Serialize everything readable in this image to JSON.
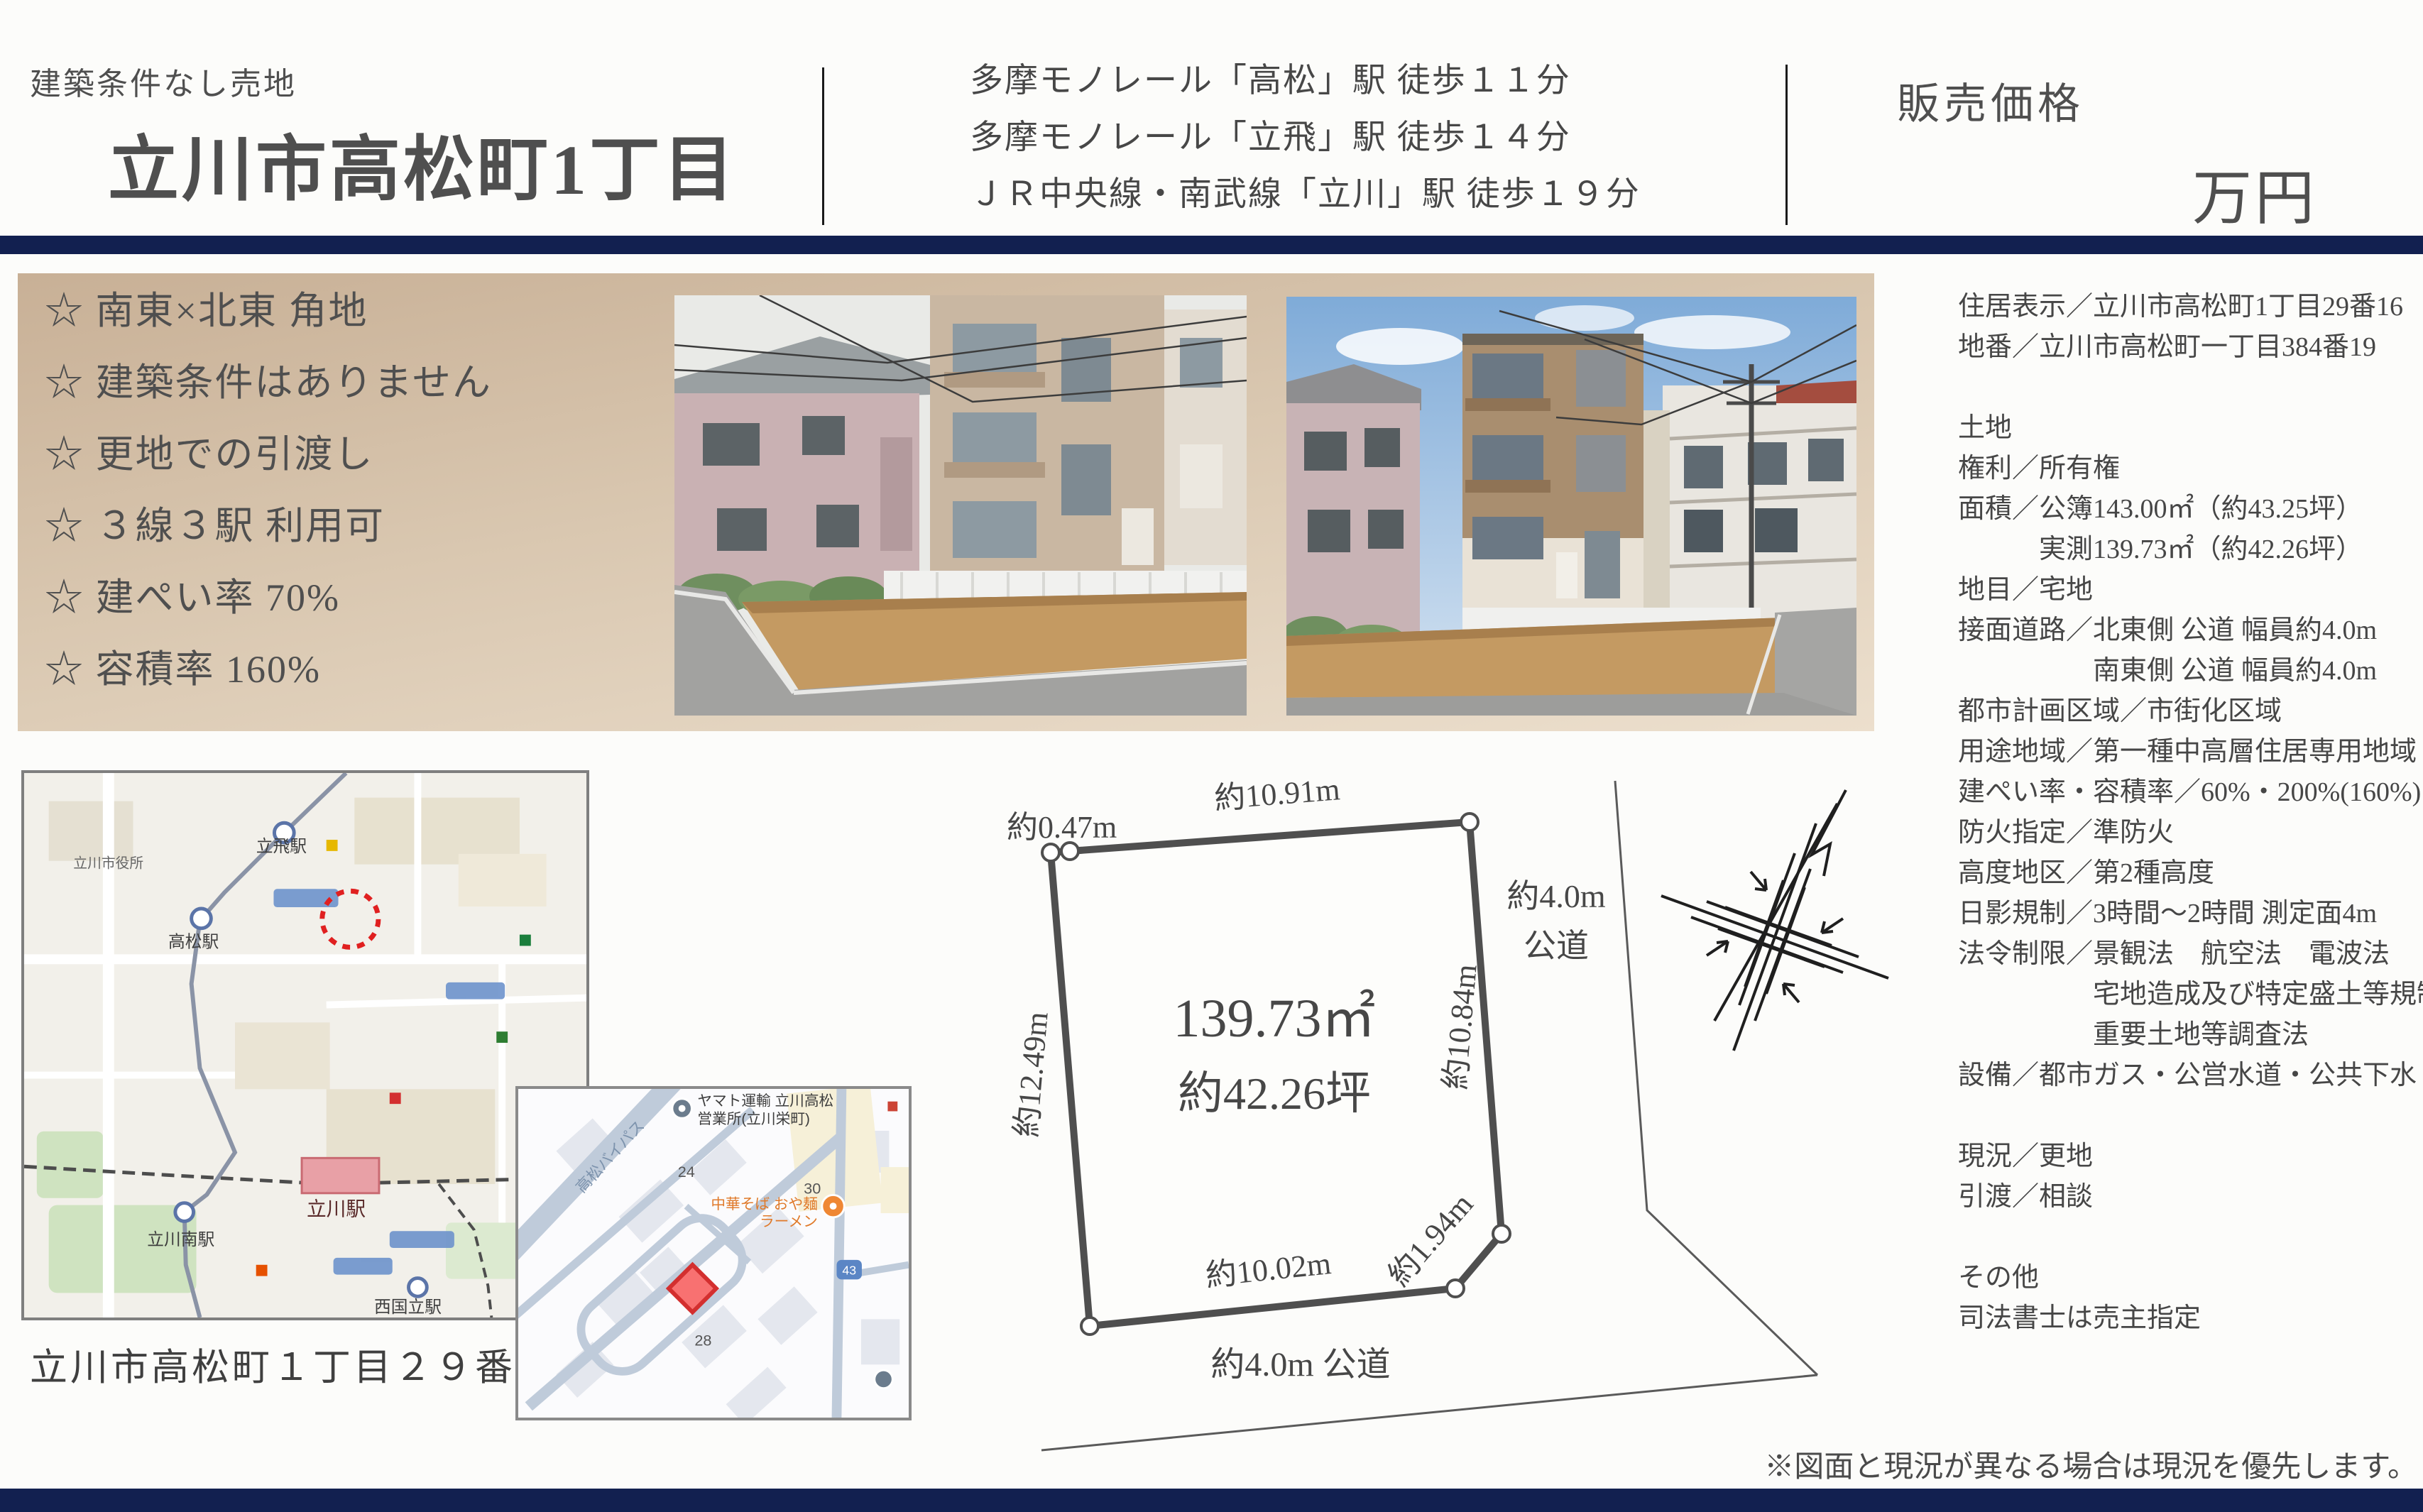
{
  "colors": {
    "navy": "#122050",
    "marker_red": "#e53935",
    "dirt": "#c49a62"
  },
  "header": {
    "small_label": "建築条件なし売地",
    "title": "立川市高松町1丁目",
    "access": [
      "多摩モノレール「高松」駅 徒歩１１分",
      "多摩モノレール「立飛」駅 徒歩１４分",
      "ＪＲ中央線・南武線「立川」駅 徒歩１９分"
    ],
    "price_label": "販売価格",
    "price_unit": "万円"
  },
  "highlights": [
    "☆ 南東×北東 角地",
    "☆ 建築条件はありません",
    "☆ 更地での引渡し",
    "☆ ３線３駅 利用可",
    "☆ 建ぺい率 70%",
    "☆ 容積率 160%"
  ],
  "details": {
    "lines": [
      "住居表示／立川市高松町1丁目29番16",
      "地番／立川市高松町一丁目384番19",
      "",
      "土地",
      "権利／所有権",
      "面積／公簿143.00㎡（約43.25坪）",
      "　　　実測139.73㎡（約42.26坪）",
      "地目／宅地",
      "接面道路／北東側 公道 幅員約4.0m",
      "　　　　　南東側 公道 幅員約4.0m",
      "都市計画区域／市街化区域",
      "用途地域／第一種中高層住居専用地域",
      "建ぺい率・容積率／60%・200%(160%)",
      "防火指定／準防火",
      "高度地区／第2種高度",
      "日影規制／3時間～2時間 測定面4m",
      "法令制限／景観法　航空法　電波法",
      "　　　　　宅地造成及び特定盛土等規制法",
      "　　　　　重要土地等調査法",
      "設備／都市ガス・公営水道・公共下水",
      "",
      "現況／更地",
      "引渡／相談",
      "",
      "その他",
      "司法書士は売主指定"
    ]
  },
  "lot": {
    "seg_047": "約0.47m",
    "seg_top": "約10.91m",
    "seg_left": "約12.49m",
    "seg_right": "約10.84m",
    "seg_corner": "約1.94m",
    "seg_bottom": "約10.02m",
    "area_m2": "139.73㎡",
    "area_tsubo": "約42.26坪",
    "road_bottom": "約4.0m 公道",
    "road_right_1": "約4.0m",
    "road_right_2": "公道"
  },
  "maps": {
    "caption": "立川市高松町１丁目２９番１６",
    "wide": {
      "city_hall": "立川市役所",
      "st_tachihi": "立飛駅",
      "st_takamatsu": "高松駅",
      "st_tachikawa": "立川駅",
      "st_tachikawa_minami": "立川南駅",
      "st_nishikunitachi": "西国立駅"
    },
    "inset": {
      "pin_yamato_1": "ヤマト運輸 立川高松",
      "pin_yamato_2": "営業所(立川栄町)",
      "road_bypass": "高松バイパス",
      "ramen_1": "中華そば おや麺",
      "ramen_2": "ラーメン",
      "block_24": "24",
      "block_30": "30",
      "block_28": "28",
      "route_shield": "43"
    }
  },
  "disclaimer": "※図面と現況が異なる場合は現況を優先します。"
}
